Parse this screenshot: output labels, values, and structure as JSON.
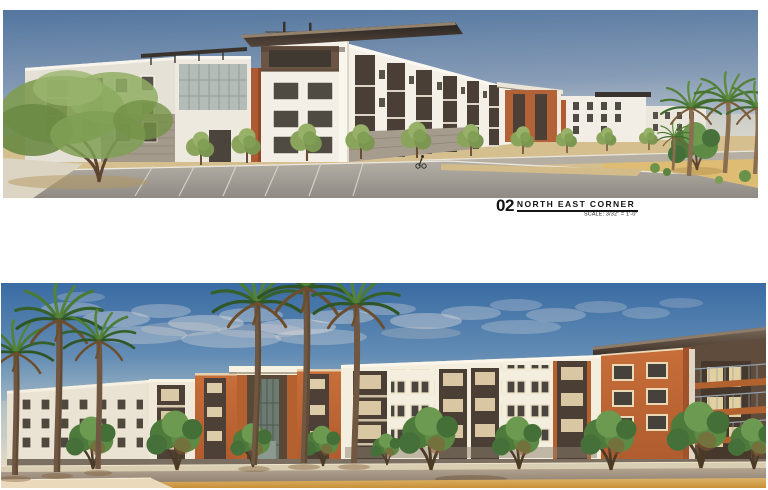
{
  "label": {
    "number": "02",
    "title": "NORTH EAST CORNER",
    "scale": "SCALE: 3/32\" = 1'-0\""
  },
  "figures": {
    "top": {
      "name": "North East Corner perspective rendering"
    },
    "bottom": {
      "name": "Street level perspective rendering"
    }
  },
  "palette": {
    "page_background": "#ffffff",
    "sky_top": "#3a6ba3",
    "sky_horizon": "#e7d9bd",
    "building_white": "#f4eedf",
    "accent_orange": "#bf6633",
    "roof_dark_brown": "#3e322a",
    "stucco_brown": "#6e5646",
    "asphalt_gray": "#9b958b",
    "desert_sand": "#d8ae63",
    "tree_green": "#5d8a45",
    "label_text": "#141414"
  }
}
